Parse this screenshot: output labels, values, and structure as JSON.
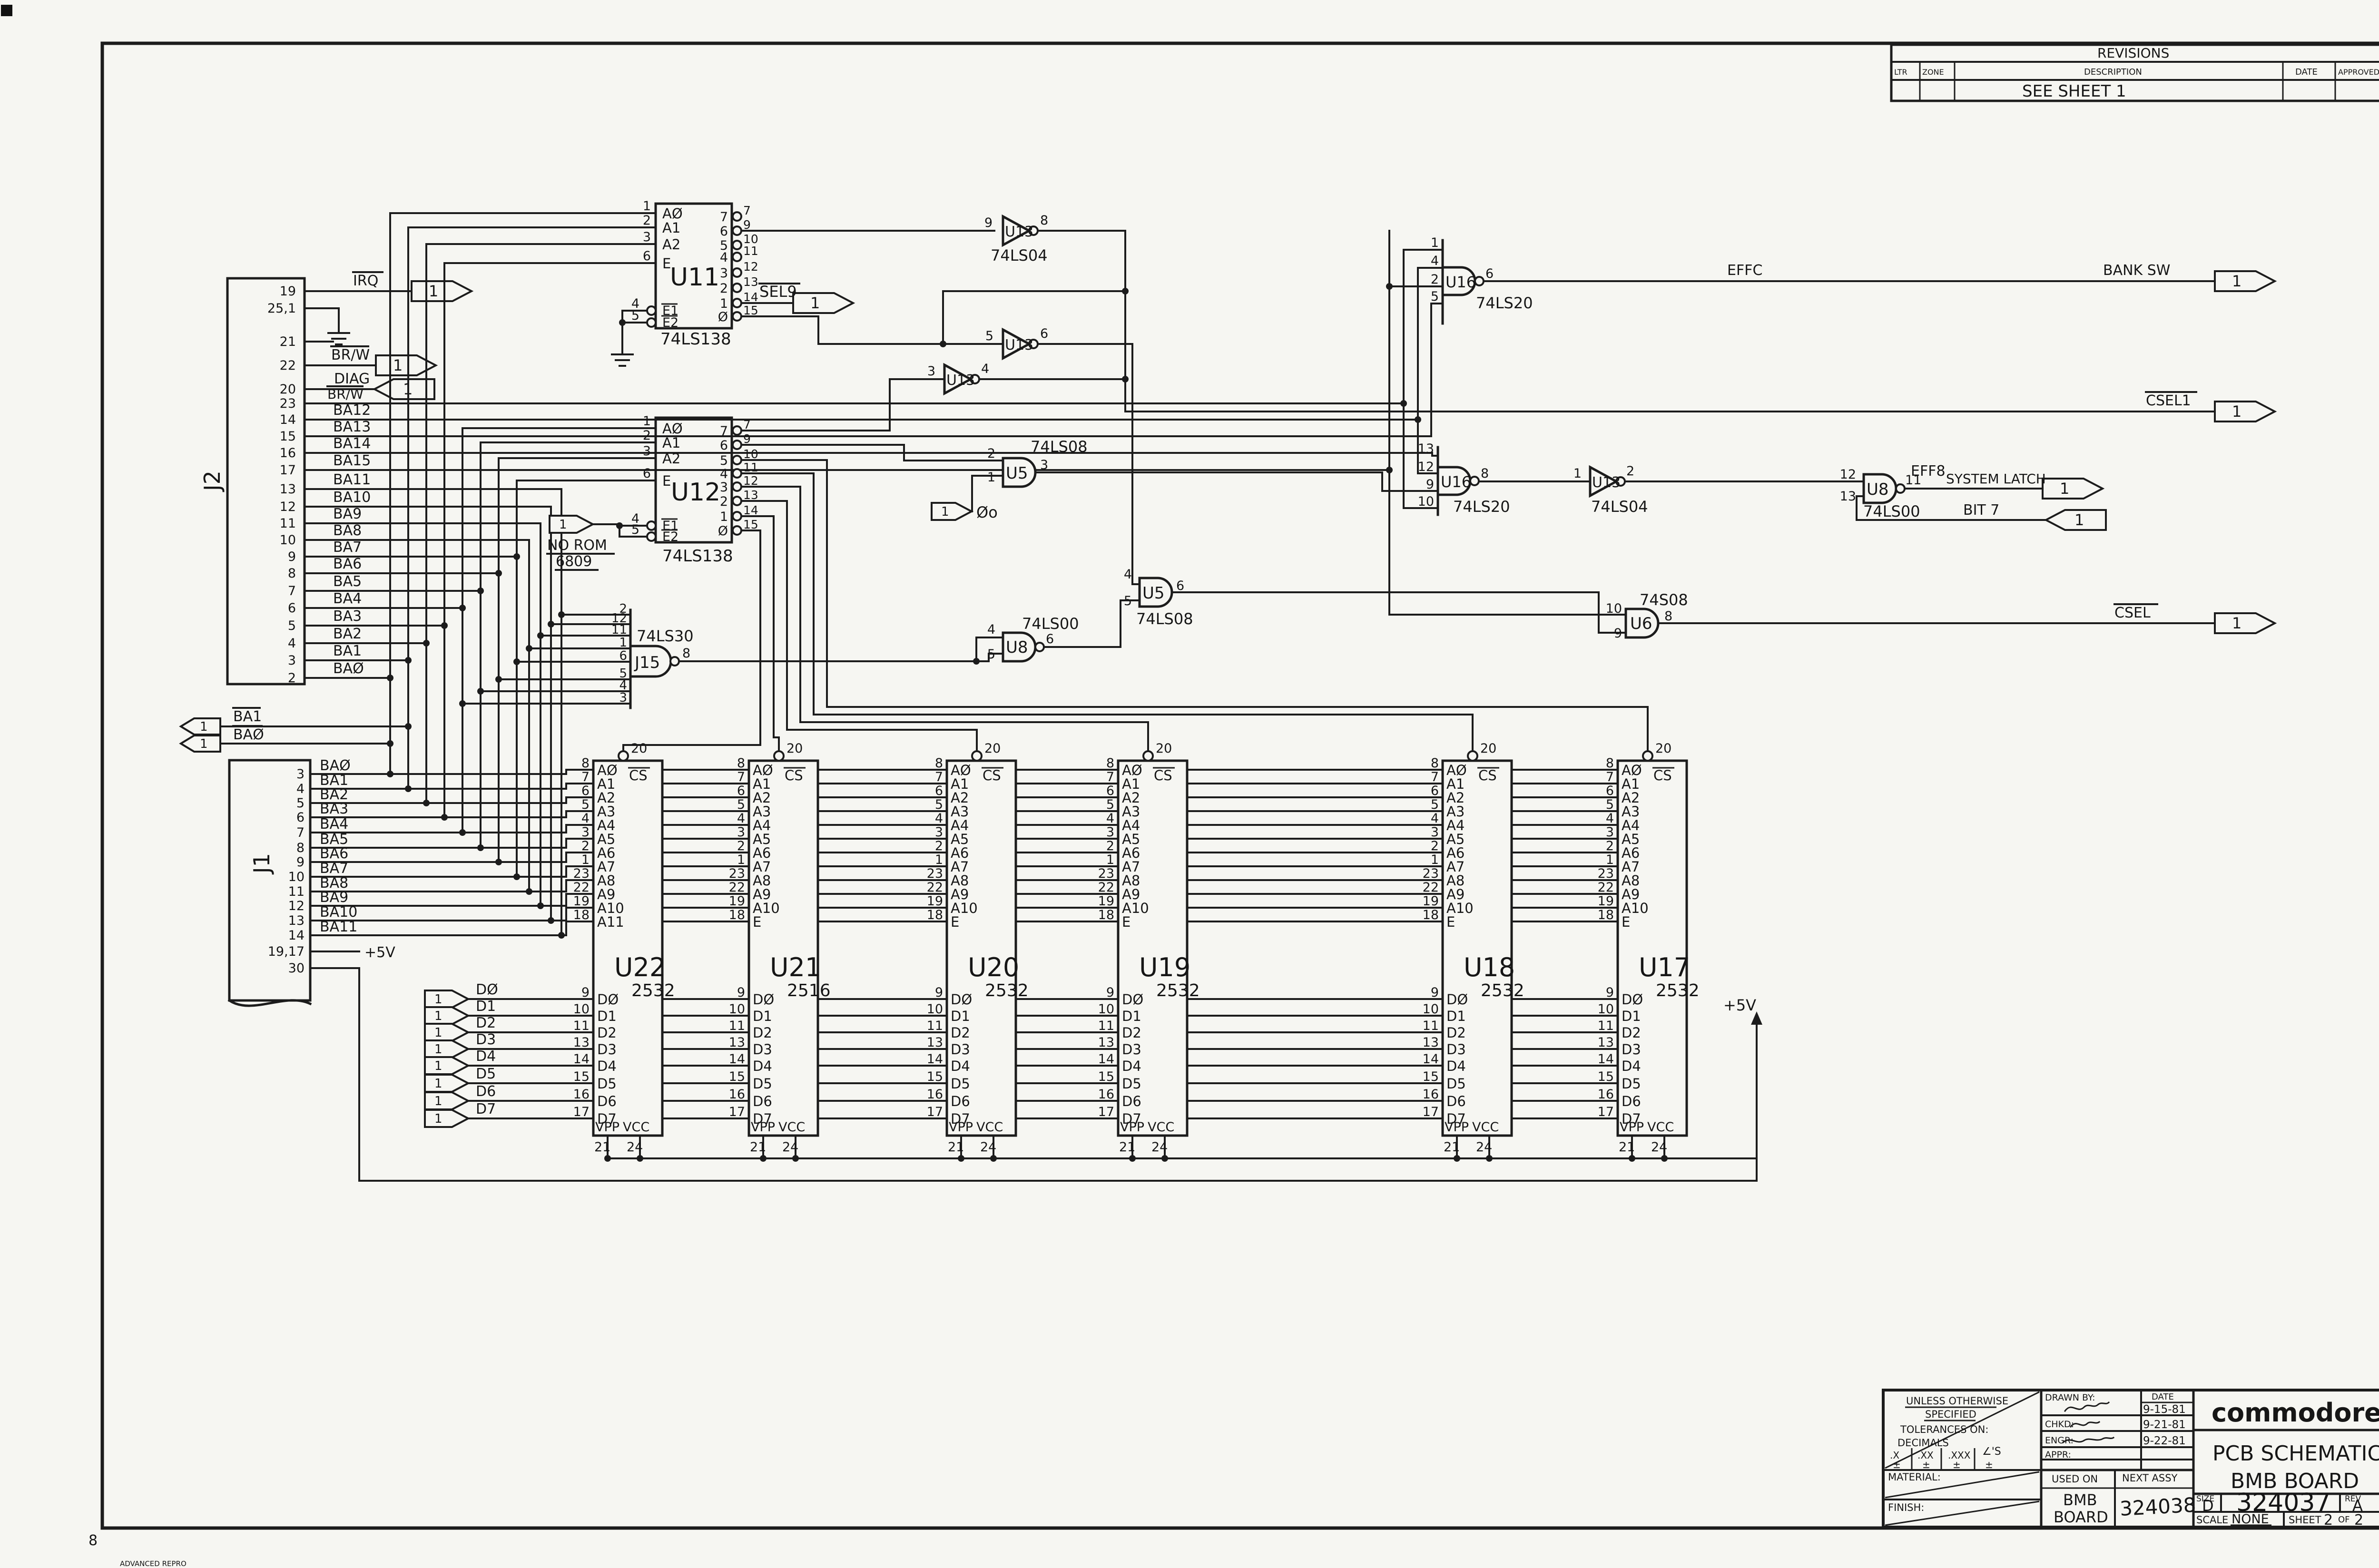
{
  "frame": {
    "zone_number": "8",
    "repro_note": "ADVANCED REPRO",
    "sheet_flag": "1"
  },
  "revisions": {
    "title": "REVISIONS",
    "ltr": "LTR",
    "zone": "ZONE",
    "description": "DESCRIPTION",
    "date": "DATE",
    "approved": "APPROVED",
    "entry": "SEE  SHEET  1"
  },
  "j2": {
    "ref": "J2",
    "pins": [
      {
        "num": "19",
        "label": "IRQ"
      },
      {
        "num": "25,1",
        "label": ""
      },
      {
        "num": "21",
        "label": ""
      },
      {
        "num": "22",
        "label": "BR/W"
      },
      {
        "num": "20",
        "label": "DIAG"
      },
      {
        "num": "23",
        "label": "BR/W"
      },
      {
        "num": "14",
        "label": "BA12"
      },
      {
        "num": "15",
        "label": "BA13"
      },
      {
        "num": "16",
        "label": "BA14"
      },
      {
        "num": "17",
        "label": "BA15"
      },
      {
        "num": "13",
        "label": "BA11"
      },
      {
        "num": "12",
        "label": "BA10"
      },
      {
        "num": "11",
        "label": "BA9"
      },
      {
        "num": "10",
        "label": "BA8"
      },
      {
        "num": "9",
        "label": "BA7"
      },
      {
        "num": "8",
        "label": "BA6"
      },
      {
        "num": "7",
        "label": "BA5"
      },
      {
        "num": "6",
        "label": "BA4"
      },
      {
        "num": "5",
        "label": "BA3"
      },
      {
        "num": "4",
        "label": "BA2"
      },
      {
        "num": "3",
        "label": "BA1"
      },
      {
        "num": "2",
        "label": "BAØ"
      }
    ]
  },
  "j1": {
    "ref": "J1",
    "pins": [
      {
        "num": "3",
        "label": "BAØ"
      },
      {
        "num": "4",
        "label": "BA1"
      },
      {
        "num": "5",
        "label": "BA2"
      },
      {
        "num": "6",
        "label": "BA3"
      },
      {
        "num": "7",
        "label": "BA4"
      },
      {
        "num": "8",
        "label": "BA5"
      },
      {
        "num": "9",
        "label": "BA6"
      },
      {
        "num": "10",
        "label": "BA7"
      },
      {
        "num": "11",
        "label": "BA8"
      },
      {
        "num": "12",
        "label": "BA9"
      },
      {
        "num": "13",
        "label": "BA10"
      },
      {
        "num": "14",
        "label": "BA11"
      },
      {
        "num": "19,17",
        "label": "+5V"
      },
      {
        "num": "30",
        "label": ""
      }
    ]
  },
  "u11": {
    "ref": "U11",
    "part": "74LS138",
    "left": [
      {
        "num": "1",
        "label": "AØ"
      },
      {
        "num": "2",
        "label": "A1"
      },
      {
        "num": "3",
        "label": "A2"
      },
      {
        "num": "6",
        "label": "E"
      }
    ],
    "en": [
      {
        "num": "4",
        "label": "E1"
      },
      {
        "num": "5",
        "label": "E2"
      }
    ],
    "right": [
      {
        "out": "7",
        "num": "7"
      },
      {
        "out": "6",
        "num": "9"
      },
      {
        "out": "5",
        "num": "10"
      },
      {
        "out": "4",
        "num": "11"
      },
      {
        "out": "3",
        "num": "12"
      },
      {
        "out": "2",
        "num": "13"
      },
      {
        "out": "1",
        "num": "14"
      },
      {
        "out": "Ø",
        "num": "15"
      }
    ]
  },
  "u12": {
    "ref": "U12",
    "part": "74LS138",
    "left": [
      {
        "num": "1",
        "label": "AØ"
      },
      {
        "num": "2",
        "label": "A1"
      },
      {
        "num": "3",
        "label": "A2"
      },
      {
        "num": "6",
        "label": "E"
      }
    ],
    "en": [
      {
        "num": "4",
        "label": "E1"
      },
      {
        "num": "5",
        "label": "E2"
      }
    ],
    "right": [
      {
        "out": "7",
        "num": "7"
      },
      {
        "out": "6",
        "num": "9"
      },
      {
        "out": "5",
        "num": "10"
      },
      {
        "out": "4",
        "num": "11"
      },
      {
        "out": "3",
        "num": "12"
      },
      {
        "out": "2",
        "num": "13"
      },
      {
        "out": "1",
        "num": "14"
      },
      {
        "out": "Ø",
        "num": "15"
      }
    ]
  },
  "j15": {
    "ref": "J15",
    "part": "74LS30",
    "pins": [
      "2",
      "12",
      "11",
      "1",
      "6",
      "5",
      "4",
      "3"
    ],
    "out": "8"
  },
  "gates": {
    "u13a": {
      "ref": "U13",
      "part": "74LS04",
      "pin_in": "9",
      "pin_out": "8"
    },
    "u13b": {
      "ref": "U13",
      "pin_in": "5",
      "pin_out": "6"
    },
    "u13c": {
      "ref": "U13",
      "pin_in": "3",
      "pin_out": "4"
    },
    "u13d": {
      "ref": "U13",
      "part": "74LS04",
      "pin_in": "1",
      "pin_out": "2"
    },
    "u5a": {
      "ref": "U5",
      "part": "74LS08",
      "pin1": "2",
      "pin2": "1",
      "pin_out": "3"
    },
    "u5b": {
      "ref": "U5",
      "part": "74LS08",
      "pin1": "4",
      "pin2": "5",
      "pin_out": "6"
    },
    "u8a": {
      "ref": "U8",
      "part": "74LS00",
      "pin1": "4",
      "pin2": "5",
      "pin_out": "6"
    },
    "u8b": {
      "ref": "U8",
      "part": "74LS00",
      "pin1": "12",
      "pin2": "13",
      "pin_out": "11"
    },
    "u16a": {
      "ref": "U16",
      "part": "74LS20",
      "pins": [
        "1",
        "4",
        "2",
        "5"
      ],
      "pin_out": "6"
    },
    "u16b": {
      "ref": "U16",
      "part": "74LS20",
      "pins": [
        "13",
        "12",
        "9",
        "10"
      ],
      "pin_out": "8"
    },
    "u6": {
      "ref": "U6",
      "part": "74S08",
      "pin1": "10",
      "pin2": "9",
      "pin_out": "8"
    }
  },
  "labels": {
    "irq": "IRQ",
    "brw": "BR/W",
    "diag": "DIAG",
    "brw2": "BR/W",
    "sel9": "SEL9",
    "no_rom": "NO ROM",
    "no_rom2": "6809",
    "phi0": "Øo",
    "effc": "EFFC",
    "bank_sw": "BANK SW",
    "csel1": "CSEL1",
    "eff8": "EFF8",
    "system_latch": "SYSTEM LATCH",
    "bit7": "BIT 7",
    "csel": "CSEL",
    "plus5v": "+5V",
    "plus5v_j1": "+5V",
    "ba1": "BA1",
    "ba0": "BAØ"
  },
  "roms": [
    {
      "ref": "U22",
      "part": "2532",
      "cs_num": "20",
      "cs_label": "CS",
      "vpp": "VPP",
      "vpp_num": "21",
      "vcc": "VCC",
      "vcc_num": "24",
      "addr": [
        [
          "8",
          "AØ"
        ],
        [
          "7",
          "A1"
        ],
        [
          "6",
          "A2"
        ],
        [
          "5",
          "A3"
        ],
        [
          "4",
          "A4"
        ],
        [
          "3",
          "A5"
        ],
        [
          "2",
          "A6"
        ],
        [
          "1",
          "A7"
        ],
        [
          "23",
          "A8"
        ],
        [
          "22",
          "A9"
        ],
        [
          "19",
          "A10"
        ],
        [
          "18",
          "A11"
        ]
      ],
      "data": [
        [
          "9",
          "DØ"
        ],
        [
          "10",
          "D1"
        ],
        [
          "11",
          "D2"
        ],
        [
          "13",
          "D3"
        ],
        [
          "14",
          "D4"
        ],
        [
          "15",
          "D5"
        ],
        [
          "16",
          "D6"
        ],
        [
          "17",
          "D7"
        ]
      ]
    },
    {
      "ref": "U21",
      "part": "2516",
      "cs_num": "20",
      "cs_label": "CS",
      "vpp": "VPP",
      "vpp_num": "21",
      "vcc": "VCC",
      "vcc_num": "24",
      "addr": [
        [
          "8",
          "AØ"
        ],
        [
          "7",
          "A1"
        ],
        [
          "6",
          "A2"
        ],
        [
          "5",
          "A3"
        ],
        [
          "4",
          "A4"
        ],
        [
          "3",
          "A5"
        ],
        [
          "2",
          "A6"
        ],
        [
          "1",
          "A7"
        ],
        [
          "23",
          "A8"
        ],
        [
          "22",
          "A9"
        ],
        [
          "19",
          "A10"
        ],
        [
          "18",
          "E"
        ]
      ],
      "data": [
        [
          "9",
          "DØ"
        ],
        [
          "10",
          "D1"
        ],
        [
          "11",
          "D2"
        ],
        [
          "13",
          "D3"
        ],
        [
          "14",
          "D4"
        ],
        [
          "15",
          "D5"
        ],
        [
          "16",
          "D6"
        ],
        [
          "17",
          "D7"
        ]
      ]
    },
    {
      "ref": "U20",
      "part": "2532",
      "cs_num": "20",
      "cs_label": "CS",
      "vpp": "VPP",
      "vpp_num": "21",
      "vcc": "VCC",
      "vcc_num": "24",
      "addr": [
        [
          "8",
          "AØ"
        ],
        [
          "7",
          "A1"
        ],
        [
          "6",
          "A2"
        ],
        [
          "5",
          "A3"
        ],
        [
          "4",
          "A4"
        ],
        [
          "3",
          "A5"
        ],
        [
          "2",
          "A6"
        ],
        [
          "1",
          "A7"
        ],
        [
          "23",
          "A8"
        ],
        [
          "22",
          "A9"
        ],
        [
          "19",
          "A10"
        ],
        [
          "18",
          "E"
        ]
      ],
      "data": [
        [
          "9",
          "DØ"
        ],
        [
          "10",
          "D1"
        ],
        [
          "11",
          "D2"
        ],
        [
          "13",
          "D3"
        ],
        [
          "14",
          "D4"
        ],
        [
          "15",
          "D5"
        ],
        [
          "16",
          "D6"
        ],
        [
          "17",
          "D7"
        ]
      ]
    },
    {
      "ref": "U19",
      "part": "2532",
      "cs_num": "20",
      "cs_label": "CS",
      "vpp": "VPP",
      "vpp_num": "21",
      "vcc": "VCC",
      "vcc_num": "24",
      "addr": [
        [
          "8",
          "AØ"
        ],
        [
          "7",
          "A1"
        ],
        [
          "6",
          "A2"
        ],
        [
          "5",
          "A3"
        ],
        [
          "4",
          "A4"
        ],
        [
          "3",
          "A5"
        ],
        [
          "2",
          "A6"
        ],
        [
          "1",
          "A7"
        ],
        [
          "23",
          "A8"
        ],
        [
          "22",
          "A9"
        ],
        [
          "19",
          "A10"
        ],
        [
          "18",
          "E"
        ]
      ],
      "data": [
        [
          "9",
          "DØ"
        ],
        [
          "10",
          "D1"
        ],
        [
          "11",
          "D2"
        ],
        [
          "13",
          "D3"
        ],
        [
          "14",
          "D4"
        ],
        [
          "15",
          "D5"
        ],
        [
          "16",
          "D6"
        ],
        [
          "17",
          "D7"
        ]
      ]
    },
    {
      "ref": "U18",
      "part": "2532",
      "cs_num": "20",
      "cs_label": "CS",
      "vpp": "VPP",
      "vpp_num": "21",
      "vcc": "VCC",
      "vcc_num": "24",
      "addr": [
        [
          "8",
          "AØ"
        ],
        [
          "7",
          "A1"
        ],
        [
          "6",
          "A2"
        ],
        [
          "5",
          "A3"
        ],
        [
          "4",
          "A4"
        ],
        [
          "3",
          "A5"
        ],
        [
          "2",
          "A6"
        ],
        [
          "1",
          "A7"
        ],
        [
          "23",
          "A8"
        ],
        [
          "22",
          "A9"
        ],
        [
          "19",
          "A10"
        ],
        [
          "18",
          "E"
        ]
      ],
      "data": [
        [
          "9",
          "DØ"
        ],
        [
          "10",
          "D1"
        ],
        [
          "11",
          "D2"
        ],
        [
          "13",
          "D3"
        ],
        [
          "14",
          "D4"
        ],
        [
          "15",
          "D5"
        ],
        [
          "16",
          "D6"
        ],
        [
          "17",
          "D7"
        ]
      ]
    },
    {
      "ref": "U17",
      "part": "2532",
      "cs_num": "20",
      "cs_label": "CS",
      "vpp": "VPP",
      "vpp_num": "21",
      "vcc": "VCC",
      "vcc_num": "24",
      "addr": [
        [
          "8",
          "AØ"
        ],
        [
          "7",
          "A1"
        ],
        [
          "6",
          "A2"
        ],
        [
          "5",
          "A3"
        ],
        [
          "4",
          "A4"
        ],
        [
          "3",
          "A5"
        ],
        [
          "2",
          "A6"
        ],
        [
          "1",
          "A7"
        ],
        [
          "23",
          "A8"
        ],
        [
          "22",
          "A9"
        ],
        [
          "19",
          "A10"
        ],
        [
          "18",
          "E"
        ]
      ],
      "data": [
        [
          "9",
          "DØ"
        ],
        [
          "10",
          "D1"
        ],
        [
          "11",
          "D2"
        ],
        [
          "13",
          "D3"
        ],
        [
          "14",
          "D4"
        ],
        [
          "15",
          "D5"
        ],
        [
          "16",
          "D6"
        ],
        [
          "17",
          "D7"
        ]
      ]
    }
  ],
  "data_bus": {
    "flags": [
      {
        "label": "DØ"
      },
      {
        "label": "D1"
      },
      {
        "label": "D2"
      },
      {
        "label": "D3"
      },
      {
        "label": "D4"
      },
      {
        "label": "D5"
      },
      {
        "label": "D6"
      },
      {
        "label": "D7"
      }
    ]
  },
  "title_block": {
    "unless1": "UNLESS OTHERWISE",
    "unless2": "SPECIFIED",
    "tol1": "TOLERANCES ON:",
    "tol2": "DECIMALS",
    "dx": ".X",
    "dxx": ".XX",
    "dxxx": ".XXX",
    "angles": "∠'S",
    "pm1": "±",
    "pm2": "±",
    "pm3": "±",
    "pm4": "±",
    "material": "MATERIAL:",
    "finish": "FINISH:",
    "drawn_by": "DRAWN BY:",
    "date": "DATE",
    "date1": "9-15-81",
    "chkd": "CHKD:",
    "date2": "9-21-81",
    "engr": "ENGR:",
    "date3": "9-22-81",
    "appr": "APPR:",
    "used_on": "USED ON",
    "next_assy": "NEXT ASSY",
    "used_on_val1": "BMB",
    "used_on_val2": "BOARD",
    "next_assy_val": "324038",
    "brand": "commodore",
    "title1": "PCB  SCHEMATIC",
    "title2": "BMB  BOARD",
    "size_label": "SIZE",
    "size": "D",
    "drawing_no": "324037",
    "rev_label": "REV",
    "rev": "A",
    "scale_label": "SCALE",
    "scale": "NONE",
    "sheet_label": "SHEET",
    "sheet_no": "2",
    "of": "OF",
    "sheet_total": "2"
  }
}
